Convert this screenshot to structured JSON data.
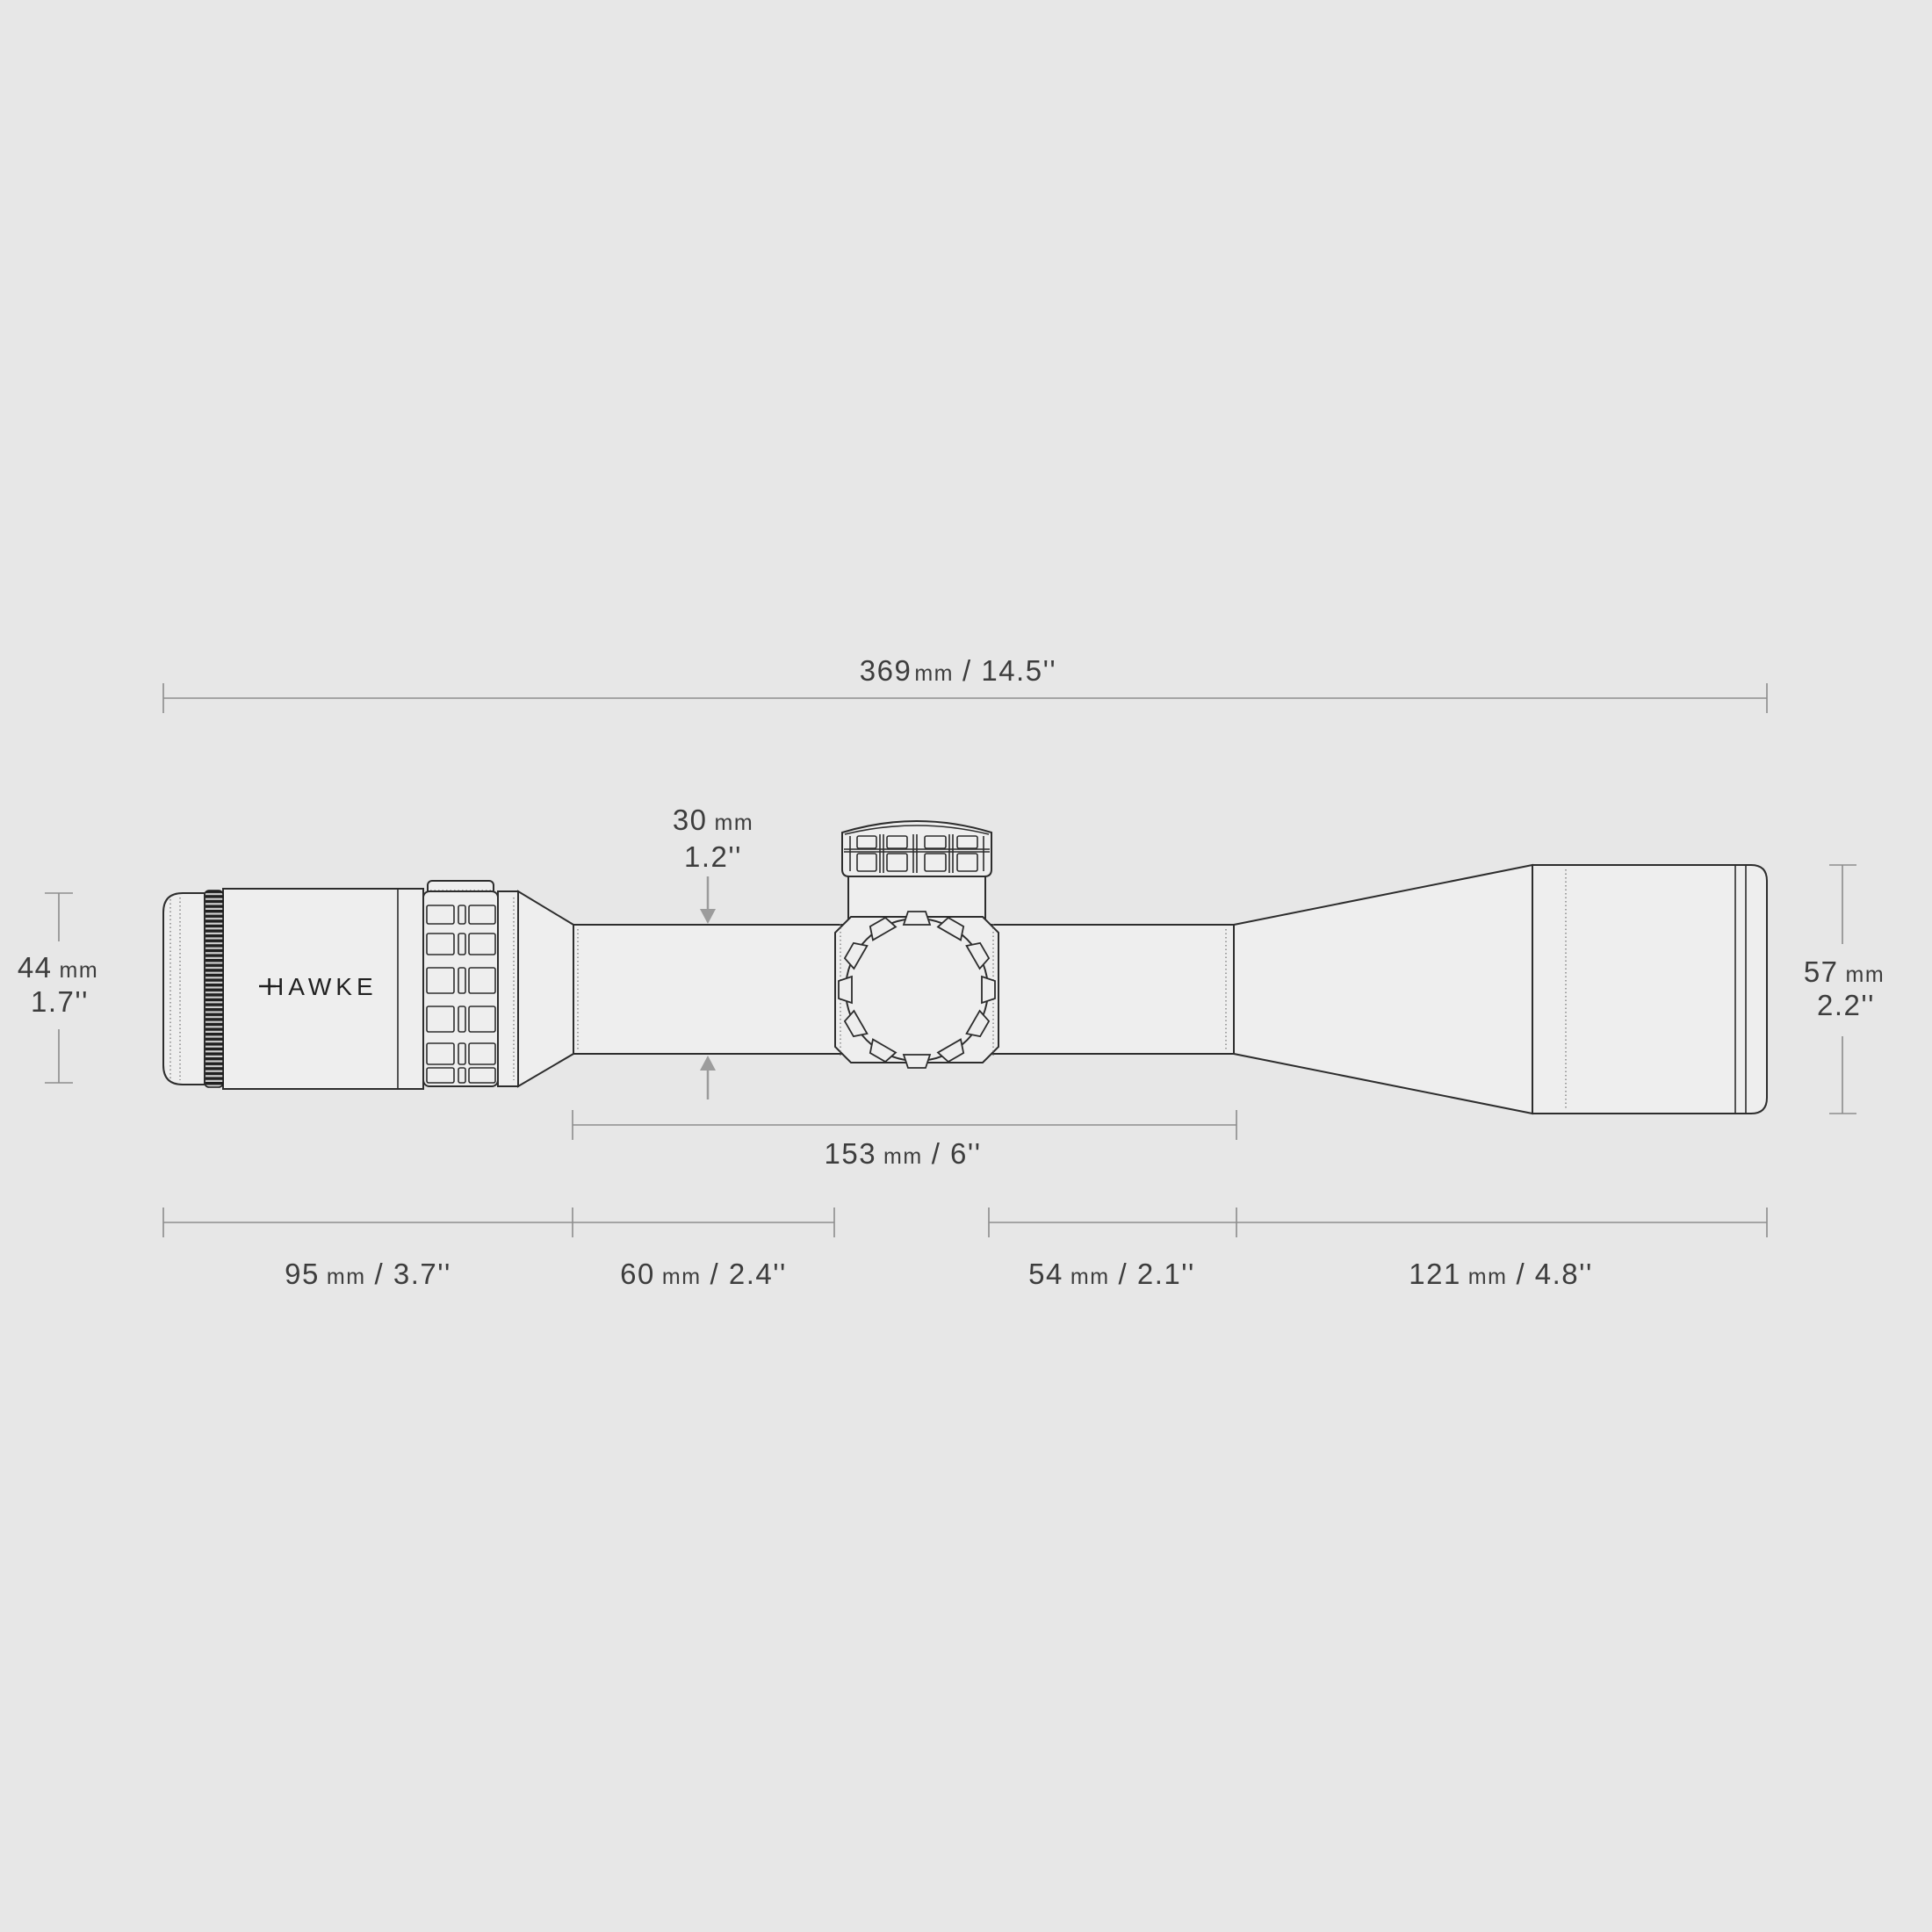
{
  "brand": {
    "logo": "HAWKE"
  },
  "labels": {
    "total": {
      "num": "369",
      "unit": "mm",
      "imp": "/ 14.5''"
    },
    "eyepiece_d": {
      "num": "44",
      "unit": "mm",
      "imp": "1.7''"
    },
    "objective_d": {
      "num": "57",
      "unit": "mm",
      "imp": "2.2''"
    },
    "tube_d": {
      "num": "30",
      "unit": "mm",
      "imp": "1.2''"
    },
    "tube_len": {
      "num": "153",
      "unit": "mm",
      "imp": "/ 6''"
    },
    "seg_eyepiece": {
      "num": "95",
      "unit": "mm",
      "imp": "/ 3.7''"
    },
    "seg_tube_left": {
      "num": "60",
      "unit": "mm",
      "imp": "/ 2.4''"
    },
    "seg_tube_right": {
      "num": "54",
      "unit": "mm",
      "imp": "/ 2.1''"
    },
    "seg_objective": {
      "num": "121",
      "unit": "mm",
      "imp": "/ 4.8''"
    }
  },
  "colors": {
    "background": "#e7e7e7",
    "scope_fill": "#eeeeee",
    "outline": "#2d2d2d",
    "dimension_line": "#8d8d8d",
    "dimension_text": "#3d3d3d",
    "arrow": "#9c9c9c",
    "knurl_dark": "#202020"
  }
}
